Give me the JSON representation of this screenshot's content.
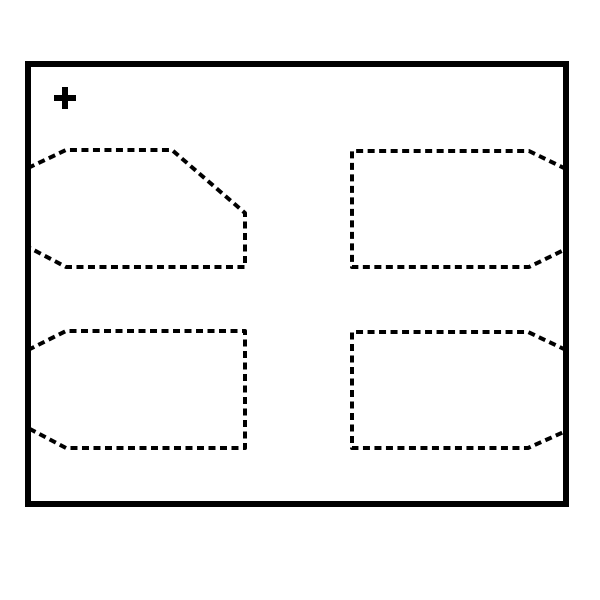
{
  "figure": {
    "description": "Package outline drawing, top view, with pin 1 plus marker and four dashed terminal pad outlines; top-left pad has large pin-1 corner chamfer",
    "background_color": "#ffffff",
    "line_color": "#000000",
    "canvas": {
      "width": 600,
      "height": 600
    },
    "package_body": {
      "x": 28,
      "y": 64,
      "width": 538,
      "height": 440,
      "stroke_width": 6
    },
    "pin1_marker": {
      "symbol": "+",
      "cx": 65,
      "cy": 98,
      "half_size": 11,
      "stroke_width": 6
    },
    "pad_style": {
      "stroke_width": 4,
      "dash": "7 4.5"
    },
    "pads": [
      {
        "name": "pad-outline-top-left",
        "points": [
          [
            28,
            168
          ],
          [
            66,
            150
          ],
          [
            172,
            150
          ],
          [
            245,
            213
          ],
          [
            245,
            267
          ],
          [
            66,
            267
          ],
          [
            28,
            247
          ]
        ]
      },
      {
        "name": "pad-outline-top-right",
        "points": [
          [
            566,
            169
          ],
          [
            529,
            151
          ],
          [
            352,
            151
          ],
          [
            352,
            267
          ],
          [
            529,
            267
          ],
          [
            566,
            249
          ]
        ]
      },
      {
        "name": "pad-outline-bottom-left",
        "points": [
          [
            28,
            350
          ],
          [
            66,
            331
          ],
          [
            245,
            331
          ],
          [
            245,
            448
          ],
          [
            66,
            448
          ],
          [
            28,
            428
          ]
        ]
      },
      {
        "name": "pad-outline-bottom-right",
        "points": [
          [
            566,
            350
          ],
          [
            528,
            332
          ],
          [
            352,
            332
          ],
          [
            352,
            448
          ],
          [
            528,
            448
          ],
          [
            566,
            431
          ]
        ]
      }
    ]
  }
}
